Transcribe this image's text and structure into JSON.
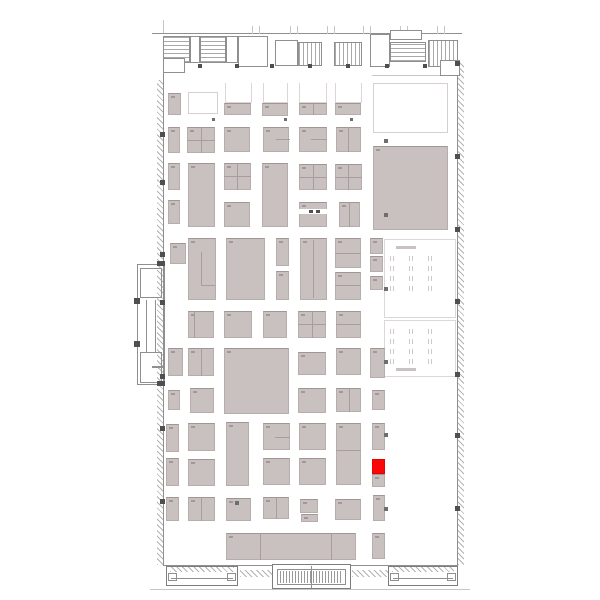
{
  "colors": {
    "background": "#ffffff",
    "booth_fill": "#c9c0c0",
    "booth_border": "#b4aaaa",
    "selected_booth": "#fa0808",
    "wall": "#8f8f8f",
    "window_line": "#b3b3b3",
    "column": "#4f4f4f"
  },
  "layers": [
    {
      "name": "hall-wall",
      "cls": "wall",
      "interactable": false,
      "items": [
        [
          163,
          36,
          1,
          530
        ],
        [
          457,
          60,
          1,
          506
        ],
        [
          152,
          33,
          310,
          1
        ],
        [
          163,
          565,
          295,
          1
        ]
      ]
    },
    {
      "name": "outer-edge-line",
      "cls": "wline",
      "interactable": false,
      "items": [
        [
          150,
          589,
          320,
          1
        ],
        [
          372,
          75,
          86,
          1
        ],
        [
          163,
          20,
          1,
          13
        ],
        [
          252,
          26,
          1,
          8
        ],
        [
          259,
          26,
          1,
          8
        ],
        [
          290,
          26,
          1,
          8
        ],
        [
          297,
          26,
          1,
          8
        ],
        [
          327,
          26,
          1,
          8
        ],
        [
          334,
          26,
          1,
          8
        ],
        [
          363,
          26,
          1,
          8
        ],
        [
          370,
          26,
          1,
          8
        ],
        [
          400,
          26,
          1,
          8
        ],
        [
          407,
          26,
          1,
          8
        ],
        [
          437,
          26,
          1,
          8
        ],
        [
          444,
          26,
          1,
          8
        ]
      ]
    },
    {
      "name": "window-band",
      "cls": "zz",
      "interactable": false,
      "items": [
        [
          157,
          80,
          6,
          485
        ],
        [
          458,
          62,
          6,
          503
        ],
        [
          240,
          570,
          32,
          7
        ],
        [
          352,
          570,
          36,
          7
        ]
      ]
    },
    {
      "name": "service-room",
      "cls": "room",
      "interactable": false,
      "items": [
        [
          163,
          36,
          27,
          27,
          "hatch-h"
        ],
        [
          190,
          36,
          10,
          27
        ],
        [
          200,
          36,
          26,
          27,
          "hatch-h"
        ],
        [
          226,
          36,
          12,
          27
        ],
        [
          238,
          36,
          30,
          31
        ],
        [
          275,
          40,
          23,
          26
        ],
        [
          298,
          42,
          24,
          24,
          "hatch-v"
        ],
        [
          334,
          42,
          28,
          24,
          "hatch-v"
        ],
        [
          370,
          34,
          20,
          33
        ],
        [
          390,
          30,
          32,
          10
        ],
        [
          390,
          42,
          36,
          20,
          "hatch-h"
        ],
        [
          428,
          40,
          30,
          27,
          "hatch-v"
        ],
        [
          440,
          60,
          20,
          16
        ],
        [
          163,
          58,
          22,
          15
        ]
      ]
    },
    {
      "name": "annex-structure",
      "cls": "outline",
      "interactable": false,
      "items": [
        [
          137,
          264,
          28,
          121
        ],
        [
          140,
          268,
          22,
          30
        ],
        [
          140,
          352,
          22,
          31
        ]
      ]
    },
    {
      "name": "annex-wall",
      "cls": "gline",
      "interactable": false,
      "items": [
        [
          146,
          300,
          1,
          52
        ],
        [
          155,
          300,
          1,
          52
        ],
        [
          152,
          366,
          11,
          2
        ]
      ]
    },
    {
      "name": "seating-area",
      "cls": "seatarea",
      "interactable": false,
      "items": [
        [
          384,
          239,
          72,
          79
        ],
        [
          384,
          320,
          72,
          57
        ]
      ]
    },
    {
      "name": "seating-table-row",
      "cls": "tables",
      "interactable": false,
      "items": [
        [
          390,
          256,
          56,
          5
        ],
        [
          390,
          266,
          56,
          5
        ],
        [
          390,
          276,
          56,
          5
        ],
        [
          390,
          286,
          56,
          5
        ],
        [
          390,
          329,
          56,
          5
        ],
        [
          390,
          339,
          56,
          5
        ],
        [
          390,
          349,
          56,
          5
        ],
        [
          390,
          359,
          56,
          5
        ]
      ]
    },
    {
      "name": "seating-counter",
      "cls": "sbar",
      "interactable": false,
      "items": [
        [
          396,
          246,
          20,
          3
        ],
        [
          396,
          368,
          20,
          3
        ]
      ]
    },
    {
      "name": "booth",
      "cls": "booth-g",
      "interactable": true,
      "items": [
        [
          168,
          93,
          13,
          22
        ],
        [
          224,
          103,
          27,
          12
        ],
        [
          262,
          103,
          26,
          13
        ],
        [
          299,
          103,
          28,
          12
        ],
        [
          335,
          103,
          26,
          12
        ],
        [
          168,
          127,
          12,
          26
        ],
        [
          187,
          127,
          28,
          26
        ],
        [
          224,
          127,
          26,
          25
        ],
        [
          263,
          127,
          26,
          25
        ],
        [
          299,
          127,
          28,
          25
        ],
        [
          336,
          127,
          25,
          25
        ],
        [
          373,
          146,
          75,
          84
        ],
        [
          168,
          163,
          12,
          27
        ],
        [
          188,
          163,
          27,
          64
        ],
        [
          224,
          163,
          27,
          27
        ],
        [
          262,
          163,
          26,
          64
        ],
        [
          299,
          164,
          28,
          26
        ],
        [
          335,
          164,
          27,
          26
        ],
        [
          168,
          200,
          12,
          24
        ],
        [
          224,
          202,
          26,
          25
        ],
        [
          299,
          202,
          28,
          25
        ],
        [
          339,
          202,
          21,
          25
        ],
        [
          170,
          243,
          16,
          21
        ],
        [
          188,
          238,
          28,
          62
        ],
        [
          226,
          238,
          39,
          62
        ],
        [
          276,
          238,
          13,
          28
        ],
        [
          276,
          271,
          13,
          29
        ],
        [
          300,
          238,
          27,
          62
        ],
        [
          335,
          238,
          26,
          30
        ],
        [
          335,
          272,
          26,
          28
        ],
        [
          370,
          238,
          13,
          16
        ],
        [
          370,
          256,
          13,
          16
        ],
        [
          370,
          276,
          13,
          14
        ],
        [
          188,
          311,
          26,
          27
        ],
        [
          224,
          311,
          28,
          27
        ],
        [
          263,
          311,
          24,
          27
        ],
        [
          298,
          311,
          28,
          27
        ],
        [
          336,
          311,
          25,
          27
        ],
        [
          168,
          348,
          15,
          28
        ],
        [
          188,
          348,
          26,
          28
        ],
        [
          224,
          348,
          65,
          66
        ],
        [
          298,
          352,
          28,
          23
        ],
        [
          336,
          348,
          25,
          27
        ],
        [
          370,
          348,
          15,
          30
        ],
        [
          168,
          390,
          12,
          20
        ],
        [
          190,
          388,
          24,
          25
        ],
        [
          298,
          388,
          28,
          25
        ],
        [
          336,
          388,
          25,
          24
        ],
        [
          372,
          390,
          13,
          20
        ],
        [
          166,
          424,
          13,
          28
        ],
        [
          188,
          423,
          27,
          28
        ],
        [
          226,
          422,
          23,
          64
        ],
        [
          263,
          423,
          27,
          27
        ],
        [
          299,
          423,
          27,
          27
        ],
        [
          336,
          423,
          25,
          62
        ],
        [
          372,
          423,
          13,
          27
        ],
        [
          166,
          458,
          13,
          28
        ],
        [
          188,
          459,
          27,
          27
        ],
        [
          263,
          458,
          27,
          27
        ],
        [
          299,
          458,
          27,
          27
        ],
        [
          372,
          474,
          13,
          13
        ],
        [
          166,
          497,
          13,
          24
        ],
        [
          188,
          497,
          27,
          24
        ],
        [
          226,
          498,
          25,
          23
        ],
        [
          263,
          497,
          26,
          22
        ],
        [
          300,
          499,
          18,
          14
        ],
        [
          301,
          514,
          17,
          8
        ],
        [
          335,
          499,
          26,
          21
        ],
        [
          373,
          495,
          12,
          26
        ],
        [
          226,
          533,
          130,
          27
        ],
        [
          372,
          533,
          13,
          26
        ]
      ]
    },
    {
      "name": "booth-open",
      "cls": "booth-w2",
      "interactable": true,
      "items": [
        [
          225,
          83,
          27,
          20
        ],
        [
          263,
          83,
          25,
          20
        ],
        [
          299,
          83,
          28,
          20
        ],
        [
          335,
          83,
          27,
          20
        ]
      ]
    },
    {
      "name": "booth-free",
      "cls": "booth-w",
      "interactable": true,
      "items": [
        [
          188,
          92,
          30,
          22
        ],
        [
          373,
          83,
          75,
          50
        ]
      ]
    },
    {
      "name": "booth-divider",
      "cls": "line",
      "interactable": false,
      "items": [
        [
          201,
          127,
          1,
          26
        ],
        [
          187,
          140,
          28,
          1
        ],
        [
          276,
          139,
          14,
          1
        ],
        [
          311,
          139,
          16,
          1
        ],
        [
          348,
          127,
          1,
          25
        ],
        [
          237,
          163,
          1,
          27
        ],
        [
          224,
          176,
          27,
          1
        ],
        [
          313,
          164,
          1,
          26
        ],
        [
          299,
          177,
          28,
          1
        ],
        [
          348,
          164,
          1,
          26
        ],
        [
          335,
          177,
          27,
          1
        ],
        [
          349,
          202,
          1,
          25
        ],
        [
          201,
          252,
          1,
          33
        ],
        [
          201,
          285,
          14,
          1
        ],
        [
          313,
          240,
          1,
          58
        ],
        [
          335,
          253,
          26,
          1
        ],
        [
          335,
          285,
          26,
          1
        ],
        [
          194,
          311,
          1,
          27
        ],
        [
          312,
          311,
          1,
          27
        ],
        [
          298,
          324,
          28,
          1
        ],
        [
          336,
          324,
          25,
          1
        ],
        [
          201,
          348,
          1,
          28
        ],
        [
          349,
          388,
          1,
          24
        ],
        [
          336,
          450,
          25,
          1
        ],
        [
          275,
          437,
          15,
          1
        ],
        [
          201,
          497,
          1,
          24
        ],
        [
          276,
          497,
          1,
          22
        ],
        [
          260,
          533,
          1,
          27
        ],
        [
          331,
          533,
          1,
          27
        ],
        [
          313,
          103,
          1,
          12
        ]
      ]
    },
    {
      "name": "booth-detail",
      "cls": "wfill",
      "interactable": false,
      "items": [
        [
          299,
          209,
          28,
          5
        ]
      ]
    },
    {
      "name": "fixture-dot",
      "cls": "coldark",
      "interactable": false,
      "items": [
        [
          309,
          210,
          4,
          3
        ],
        [
          316,
          210,
          4,
          3
        ]
      ]
    },
    {
      "name": "selected-booth",
      "cls": "booth-r",
      "interactable": true,
      "items": [
        [
          372,
          459,
          13,
          15
        ]
      ]
    },
    {
      "name": "column-marker",
      "cls": "coldark",
      "interactable": false,
      "items": [
        [
          160,
          132,
          5,
          5
        ],
        [
          160,
          180,
          5,
          5
        ],
        [
          160,
          252,
          5,
          5
        ],
        [
          160,
          300,
          5,
          5
        ],
        [
          160,
          374,
          5,
          5
        ],
        [
          160,
          426,
          5,
          5
        ],
        [
          160,
          499,
          5,
          5
        ],
        [
          455,
          61,
          5,
          5
        ],
        [
          455,
          154,
          5,
          5
        ],
        [
          455,
          227,
          5,
          5
        ],
        [
          455,
          299,
          5,
          5
        ],
        [
          455,
          372,
          5,
          5
        ],
        [
          455,
          433,
          5,
          5
        ],
        [
          455,
          506,
          5,
          5
        ],
        [
          134,
          298,
          6,
          6
        ],
        [
          134,
          341,
          6,
          6
        ],
        [
          157,
          261,
          8,
          5
        ],
        [
          157,
          381,
          8,
          5
        ],
        [
          198,
          64,
          4,
          4
        ],
        [
          235,
          64,
          4,
          4
        ],
        [
          270,
          64,
          4,
          4
        ],
        [
          308,
          64,
          4,
          4
        ],
        [
          346,
          64,
          4,
          4
        ],
        [
          385,
          64,
          4,
          4
        ],
        [
          423,
          64,
          4,
          4
        ]
      ]
    },
    {
      "name": "column-marker-hall",
      "cls": "colmid",
      "interactable": false,
      "items": [
        [
          212,
          118,
          3,
          3
        ],
        [
          284,
          118,
          3,
          3
        ],
        [
          350,
          118,
          3,
          3
        ],
        [
          384,
          139,
          4,
          4
        ],
        [
          384,
          213,
          4,
          4
        ],
        [
          384,
          287,
          4,
          4
        ],
        [
          384,
          360,
          4,
          4
        ],
        [
          384,
          433,
          4,
          4
        ],
        [
          384,
          507,
          4,
          4
        ],
        [
          235,
          501,
          4,
          4
        ]
      ]
    },
    {
      "name": "entrance-vestibule",
      "cls": "vest",
      "interactable": false,
      "items": [
        [
          166,
          566,
          72,
          20
        ],
        [
          388,
          566,
          70,
          20
        ],
        [
          272,
          564,
          79,
          25
        ]
      ]
    },
    {
      "name": "entrance-inner",
      "cls": "outline",
      "interactable": false,
      "items": [
        [
          277,
          569,
          69,
          16
        ],
        [
          168,
          573,
          9,
          8
        ],
        [
          227,
          573,
          9,
          8
        ],
        [
          390,
          573,
          9,
          8
        ],
        [
          447,
          573,
          9,
          8
        ]
      ]
    },
    {
      "name": "entrance-stairs",
      "cls": "hatch-v2",
      "interactable": false,
      "items": [
        [
          280,
          571,
          63,
          12
        ]
      ]
    },
    {
      "name": "entrance-line",
      "cls": "gline",
      "interactable": false,
      "items": [
        [
          171,
          578,
          62,
          1
        ],
        [
          393,
          578,
          60,
          1
        ],
        [
          311,
          566,
          1,
          22
        ]
      ]
    },
    {
      "name": "entrance-doors",
      "cls": "zz",
      "interactable": false,
      "items": [
        [
          170,
          567,
          64,
          5
        ],
        [
          392,
          567,
          62,
          5
        ]
      ]
    }
  ]
}
